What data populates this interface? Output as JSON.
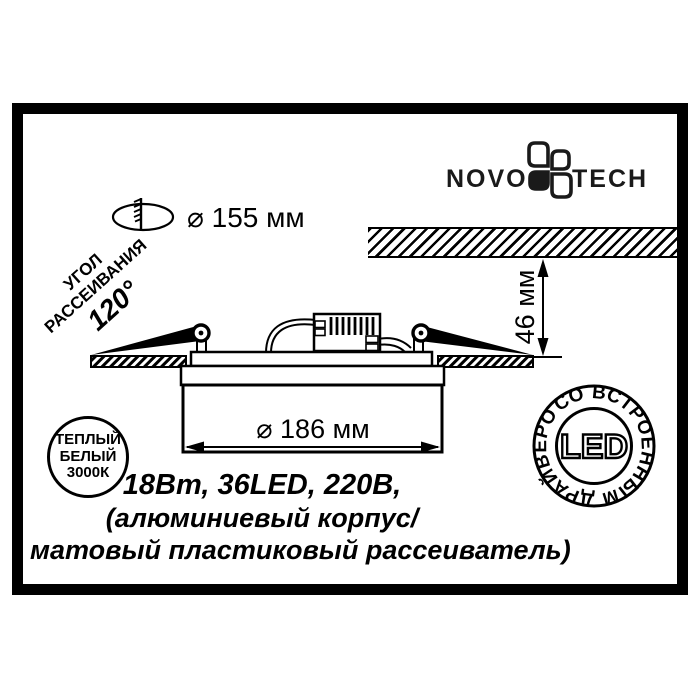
{
  "brand": {
    "name_left": "NOVO",
    "name_right": "TECH"
  },
  "top_dimension": {
    "label": "⌀ 155 мм"
  },
  "beam_angle": {
    "word1": "УГОЛ",
    "word2": "РАССЕИВАНИЯ",
    "value": "120°"
  },
  "depth_dimension": {
    "label": "46 мм"
  },
  "diameter_dimension": {
    "label": "⌀ 186 мм"
  },
  "color_temp_badge": {
    "line1": "ТЕПЛЫЙ",
    "line2": "БЕЛЫЙ",
    "line3": "3000К"
  },
  "led_badge": {
    "ring_text": "СО ВСТРОЕННЫМ ДРАЙВЕРОМ",
    "center_text": "LED"
  },
  "specs": {
    "line1": "18Вт, 36LED, 220В,",
    "line2": "(алюминиевый корпус/",
    "line3": "матовый пластиковый рассеиватель)"
  },
  "colors": {
    "ink": "#000000",
    "paper": "#ffffff"
  }
}
